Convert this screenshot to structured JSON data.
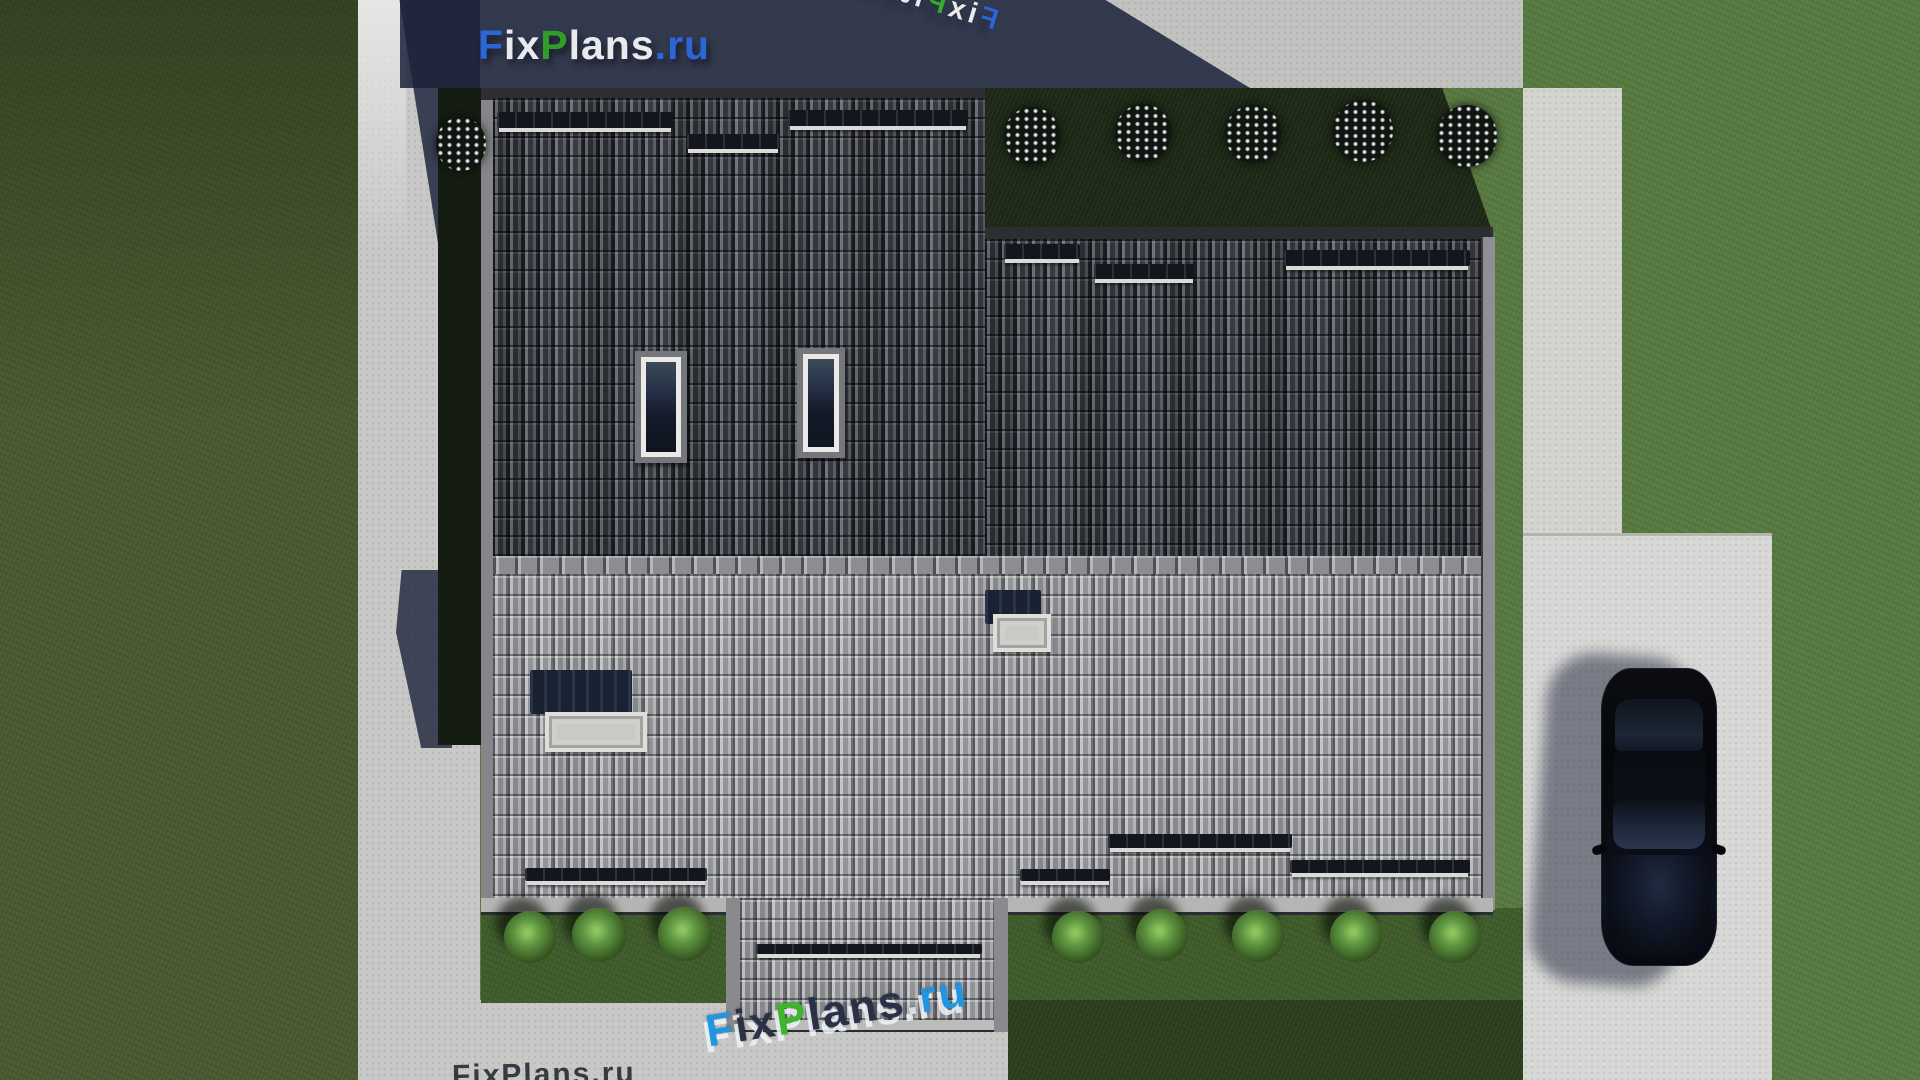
{
  "watermarks": {
    "main": {
      "text": "FixPlans.ru",
      "segments": [
        {
          "text": "F",
          "color": "#2b66d9"
        },
        {
          "text": "ix",
          "color": "#e9eaee"
        },
        {
          "text": "P",
          "color": "#2f9e28"
        },
        {
          "text": "lans",
          "color": "#e9eaee"
        },
        {
          "text": ".",
          "color": "#2b66d9"
        },
        {
          "text": "ru",
          "color": "#2b66d9"
        }
      ]
    },
    "rotated_top": {
      "text": "FixPlans.ru",
      "segments": [
        {
          "text": "F",
          "color": "#2b66d9"
        },
        {
          "text": "ix",
          "color": "#eef1f4"
        },
        {
          "text": "P",
          "color": "#35b02a"
        },
        {
          "text": "lans",
          "color": "#eef1f4"
        },
        {
          "text": ".",
          "color": "#eef1f4"
        },
        {
          "text": "ru",
          "color": "#2b66d9"
        }
      ]
    },
    "rotated_bottom": {
      "text": "FixPlans.ru",
      "segments": [
        {
          "text": "F",
          "color": "#2196e0"
        },
        {
          "text": "ix",
          "color": "#2a3147"
        },
        {
          "text": "P",
          "color": "#3eb52c"
        },
        {
          "text": "lans",
          "color": "#2a3147"
        },
        {
          "text": ".",
          "color": "#d9dee6"
        },
        {
          "text": "ru",
          "color": "#2196e0"
        }
      ]
    },
    "clipped_bottom_left": {
      "text": "FixPlans.ru"
    }
  },
  "palette": {
    "lawn_left": "#49592f",
    "lawn_right": "#587a41",
    "garden_shadowed": "#1d2916",
    "path_concrete": "#c8c8c6",
    "driveway": "#d8d8d6",
    "roof_dark_tiles": "#42454c",
    "roof_light_tiles": "#9c9da0",
    "ridge_tiles": "#8b8d92",
    "cast_shadow": "#1b2238",
    "snow_guard": "#14161d",
    "skylight_frame": "#eceae6",
    "car_body": "#07080c"
  }
}
